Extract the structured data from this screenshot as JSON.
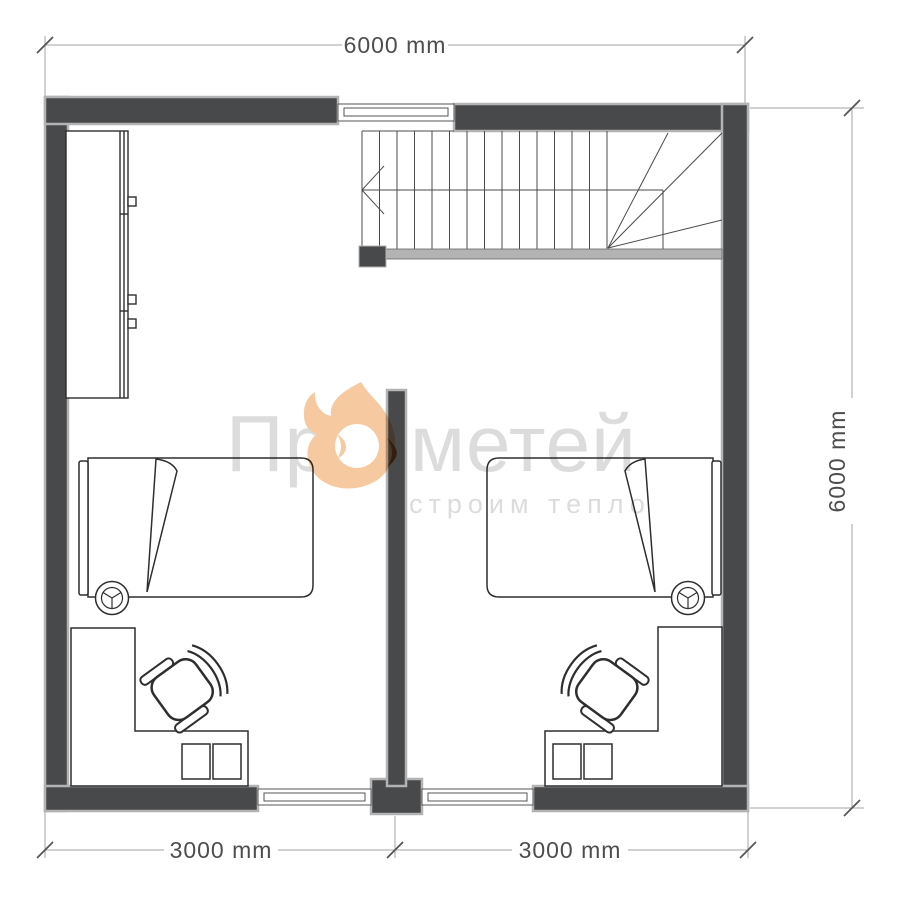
{
  "dimensions": {
    "top_width": "6000 mm",
    "right_height": "6000 mm",
    "bottom_left_room": "3000 mm",
    "bottom_right_room": "3000 mm"
  },
  "watermark": {
    "brand_full": "Прометей",
    "brand_prefix": "Пр",
    "brand_suffix": "метей",
    "tagline": "строим тепло",
    "flame_icon": "flame-icon"
  },
  "colors": {
    "wall_fill": "#47494b",
    "wall_outline": "#b3b3b3",
    "furniture_line": "#2e2e2e",
    "stair_line": "#4b4b4b",
    "dimension_line": "#a3a3a3",
    "dimension_text": "#4d4d4d",
    "watermark_text": "#dcdcdc",
    "flame_body": "#f6c9a0",
    "flame_accent": "#bf6733"
  }
}
